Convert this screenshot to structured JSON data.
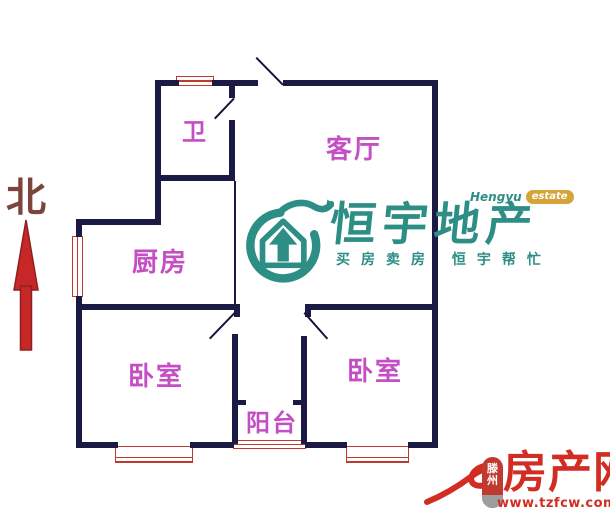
{
  "compass": {
    "label": "北"
  },
  "rooms": {
    "bathroom": {
      "label": "卫"
    },
    "living_room": {
      "label": "客厅"
    },
    "kitchen": {
      "label": "厨房"
    },
    "bedroom_left": {
      "label": "卧室"
    },
    "bedroom_right": {
      "label": "卧室"
    },
    "balcony": {
      "label": "阳台"
    }
  },
  "watermark": {
    "brand_en": "Hengyu",
    "brand_en_suffix": "estate",
    "brand_cn": "恒宇地产",
    "tagline": "买房卖房 恒宇帮忙"
  },
  "footer": {
    "city": "滕州",
    "site": "房产网",
    "url": "www.tzfcw.com.cn"
  },
  "colors": {
    "wall": "#1a1a45",
    "window": "#c0392f",
    "room_label": "#c44fc4",
    "north_text": "#7d443c",
    "arrow": "#c62828",
    "brand_teal": "#2c8e85",
    "badge_gold": "#d4a437",
    "footer_red": "#d22d23"
  }
}
